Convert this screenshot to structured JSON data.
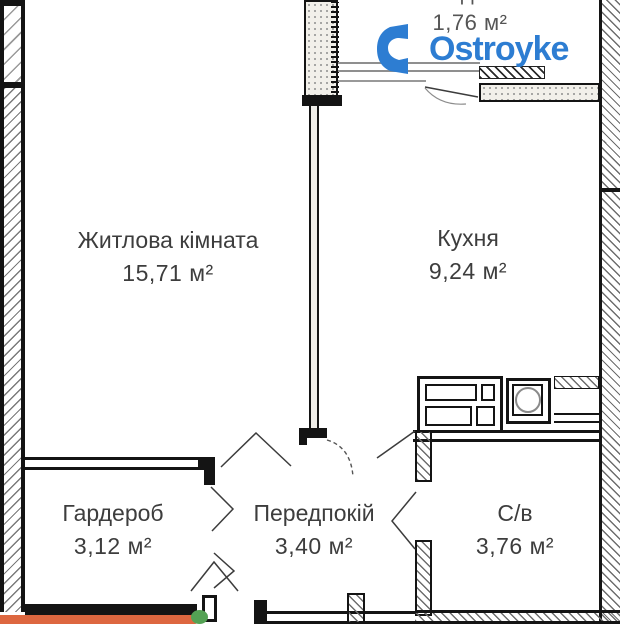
{
  "rooms": [
    {
      "id": "living",
      "name": "Житлова кімната",
      "area": "15,71 м²"
    },
    {
      "id": "kitchen",
      "name": "Кухня",
      "area": "9,24 м²"
    },
    {
      "id": "loggia",
      "name": "Лоджія",
      "area": "1,76 м²"
    },
    {
      "id": "wardrobe",
      "name": "Гардероб",
      "area": "3,12 м²"
    },
    {
      "id": "hallway",
      "name": "Передпокій",
      "area": "3,40 м²"
    },
    {
      "id": "bathroom",
      "name": "С/в",
      "area": "3,76 м²"
    }
  ],
  "watermark": {
    "text": "Ostroyke",
    "color": "#2d7dd2"
  },
  "overlay_bar": {
    "color": "#dd6740",
    "accent_color": "#54a254"
  },
  "colors": {
    "walls": "#141414",
    "labels": "#3d3d3d",
    "hatch": "#6d6d6d"
  }
}
